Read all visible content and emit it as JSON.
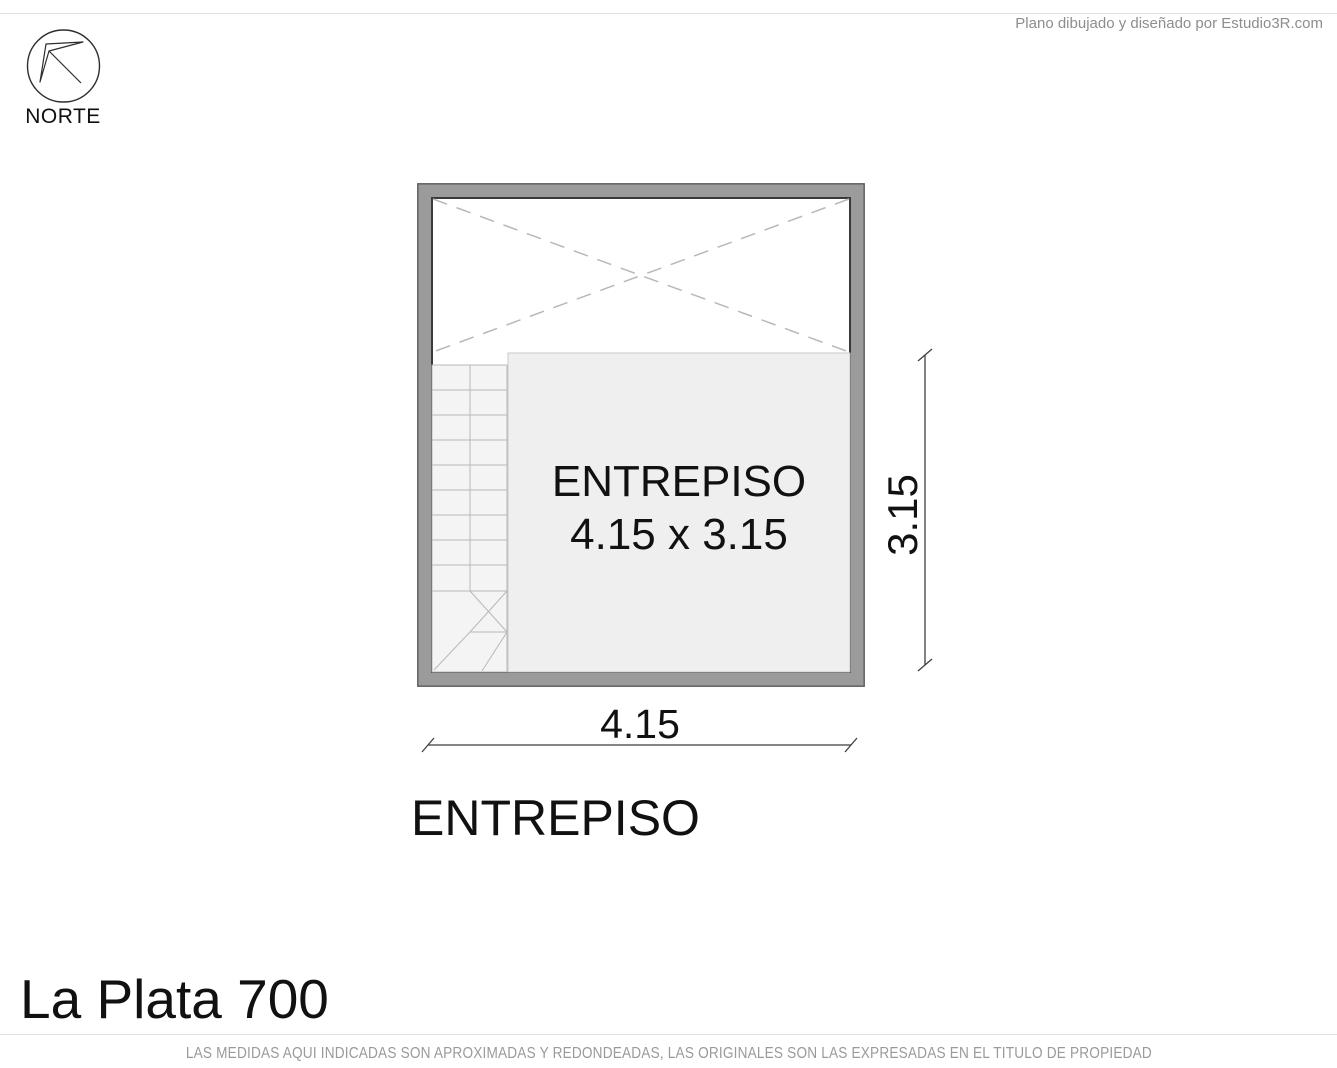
{
  "header": {
    "credit": "Plano dibujado y diseñado por Estudio3R.com",
    "compass_label": "NORTE"
  },
  "plan": {
    "room_name": "ENTREPISO",
    "room_size": "4.15 x 3.15",
    "width_dim": "4.15",
    "height_dim": "3.15",
    "floor_title": "ENTREPISO",
    "features": [
      "void-with-dashed-x",
      "staircase-left",
      "mezzanine-room"
    ]
  },
  "footer": {
    "address": "La Plata 700",
    "disclaimer": "LAS MEDIDAS AQUI INDICADAS SON APROXIMADAS Y REDONDEADAS, LAS ORIGINALES SON LAS EXPRESADAS EN EL TITULO DE PROPIEDAD"
  },
  "colors": {
    "wall": "#9b9b9b",
    "wall_outline": "#3a3a3a",
    "room_fill": "#efefef",
    "stair_fill": "#f4f4f4",
    "drawing_gray": "#b8b8b8",
    "dimension_line": "#3f3f3f",
    "text_gray": "#8d8d8d",
    "text_black": "#111111"
  }
}
